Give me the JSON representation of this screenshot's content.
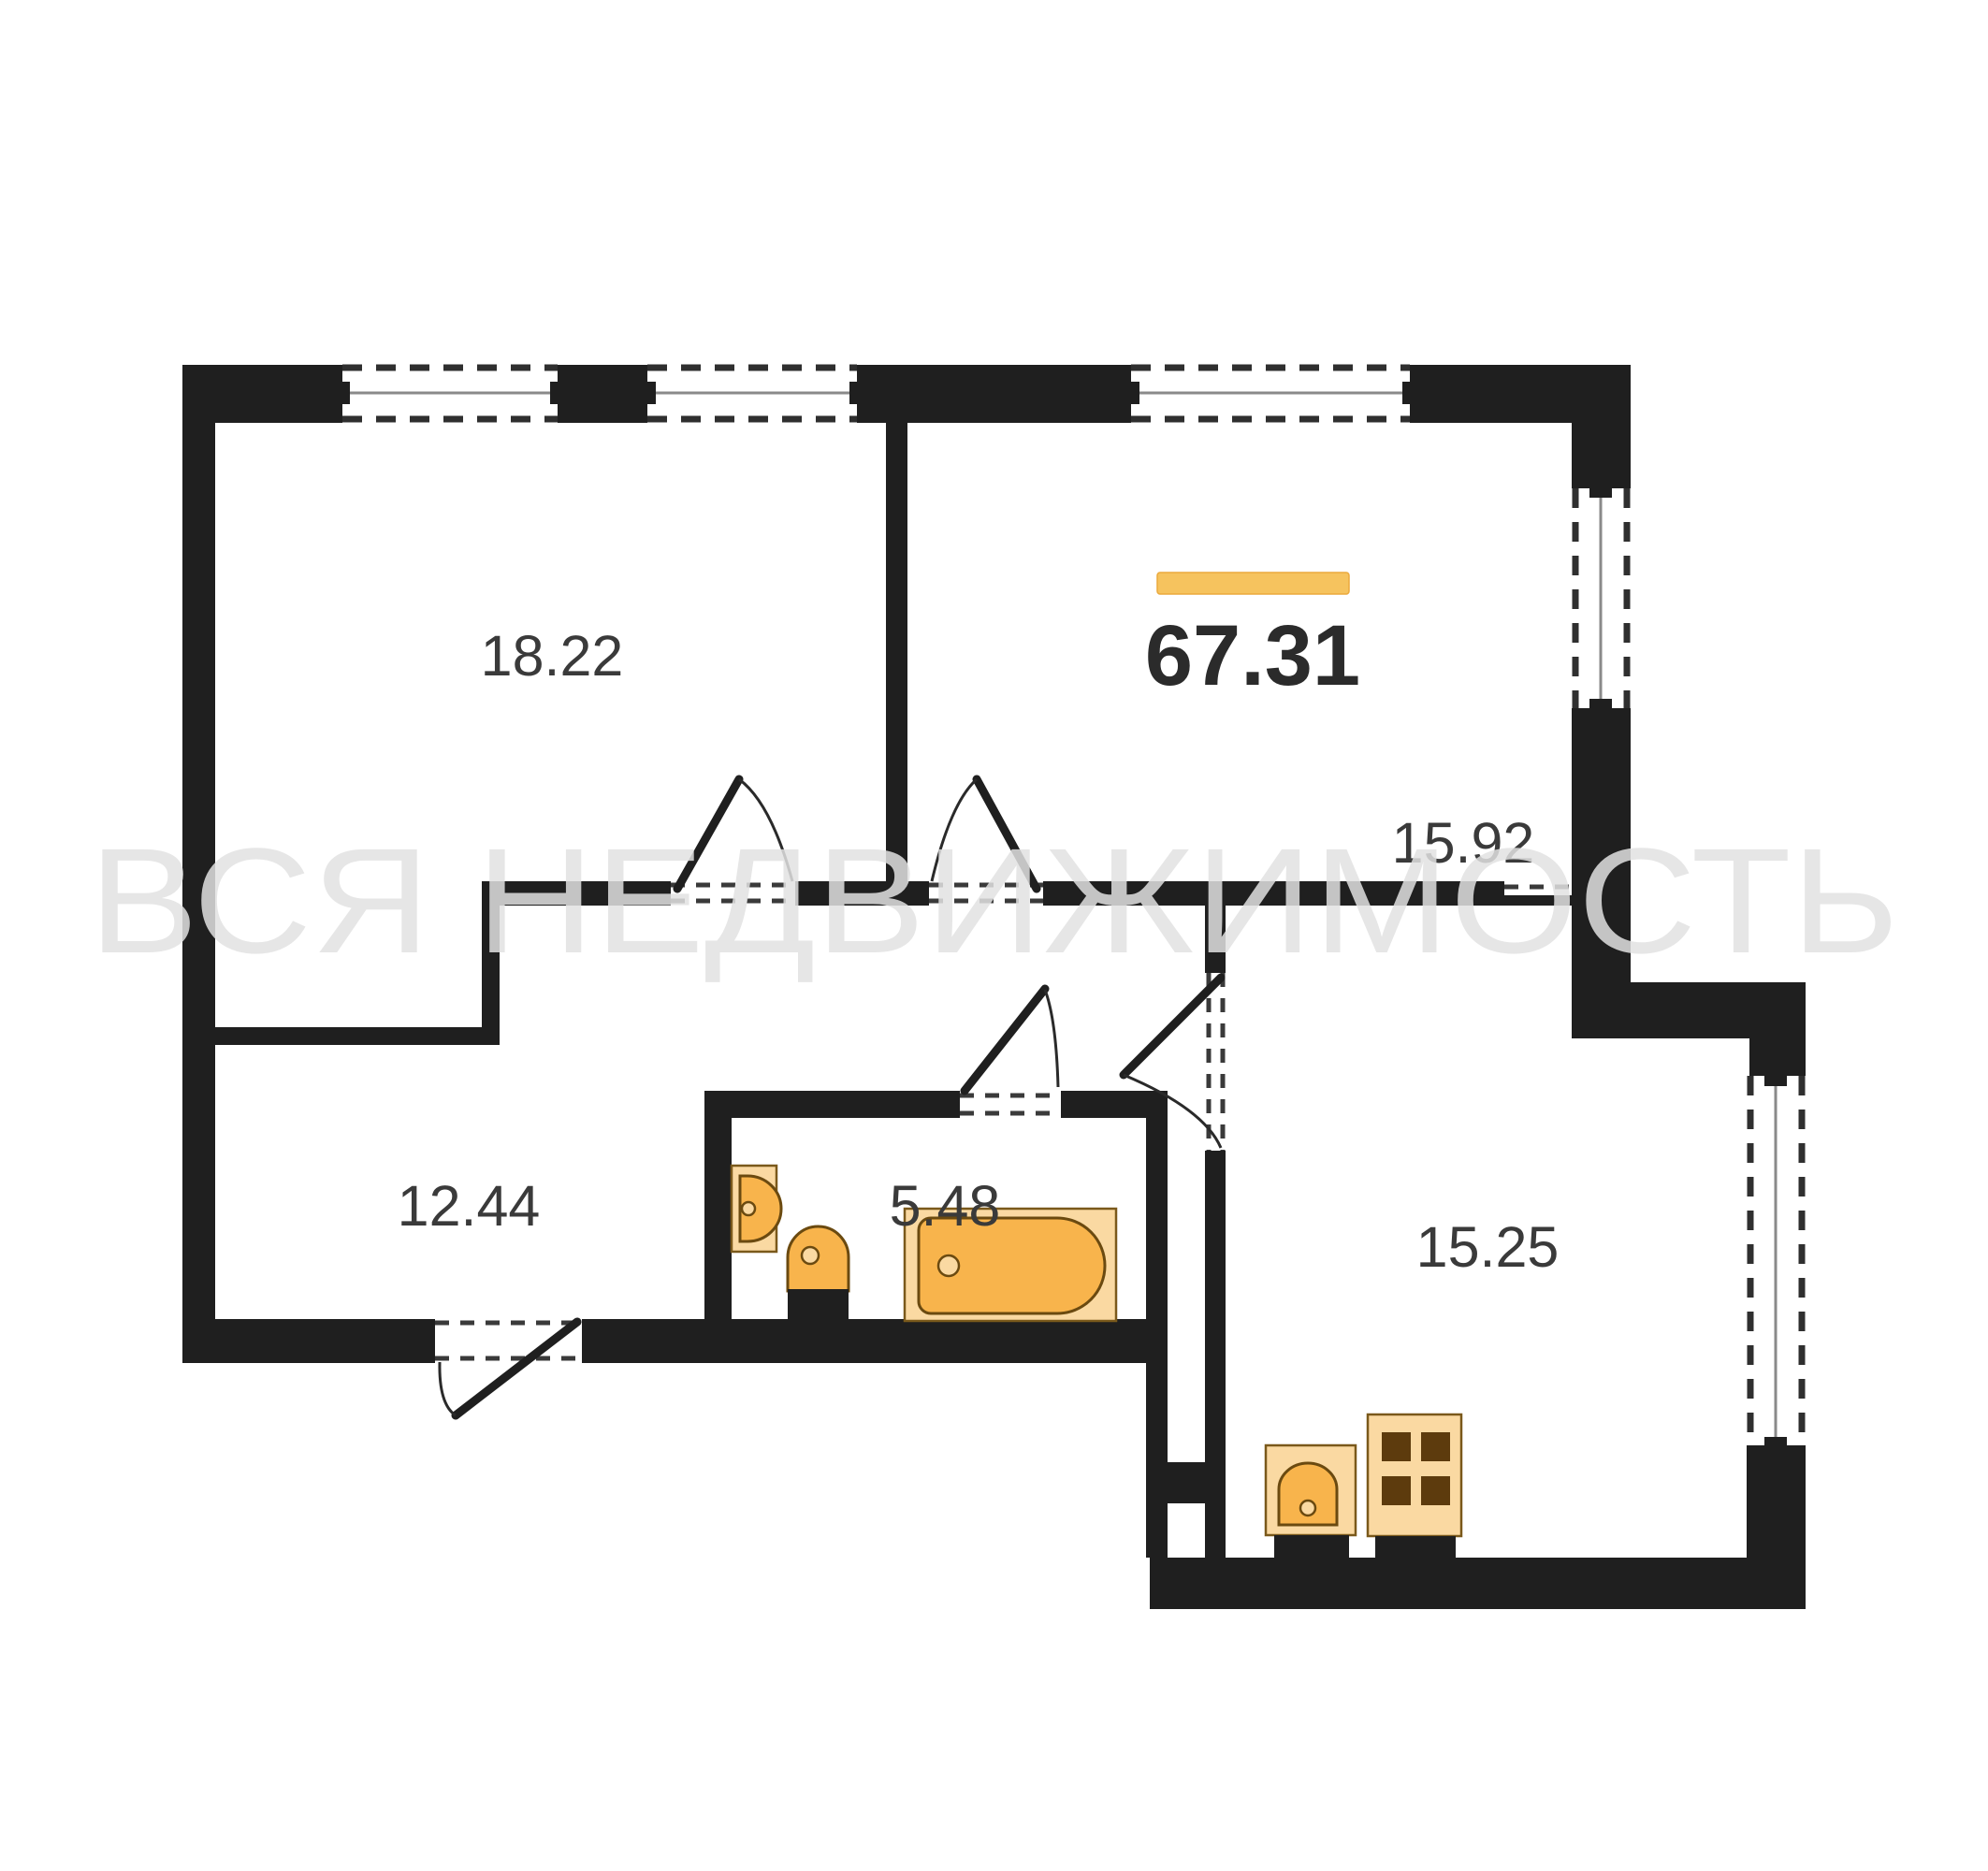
{
  "title": "Apartment floor plan 67.31 m²",
  "watermark": {
    "text": "ВСЯ НЕДВИЖИМОСТЬ"
  },
  "total_area": {
    "value": "67.31",
    "bar_color": "#F6C35E"
  },
  "rooms": [
    {
      "name": "living-room",
      "area": "18.22"
    },
    {
      "name": "bedroom",
      "area": "15.92"
    },
    {
      "name": "room-lower-left",
      "area": "12.44"
    },
    {
      "name": "bathroom",
      "area": "5.48"
    },
    {
      "name": "kitchen",
      "area": "15.25"
    }
  ],
  "fixtures": [
    "wall-sink",
    "toilet",
    "bathtub",
    "kitchen-sink",
    "stove-4-burner"
  ],
  "colors": {
    "wall": "#1f1f1f",
    "accent": "#F6C35E",
    "accent-edge": "#EBA93C",
    "fixture": "#F8B44C",
    "fixture-light": "#FAD9A2",
    "fixture-border": "#6B4A10",
    "fixture-border-light": "#7A591B",
    "label": "#3a3a3a",
    "label-strong": "#2b2b2b",
    "watermark": "#e2e2e2",
    "dash": "#2f2f2f",
    "glass": "#8a8a8a",
    "bg": "#ffffff"
  }
}
